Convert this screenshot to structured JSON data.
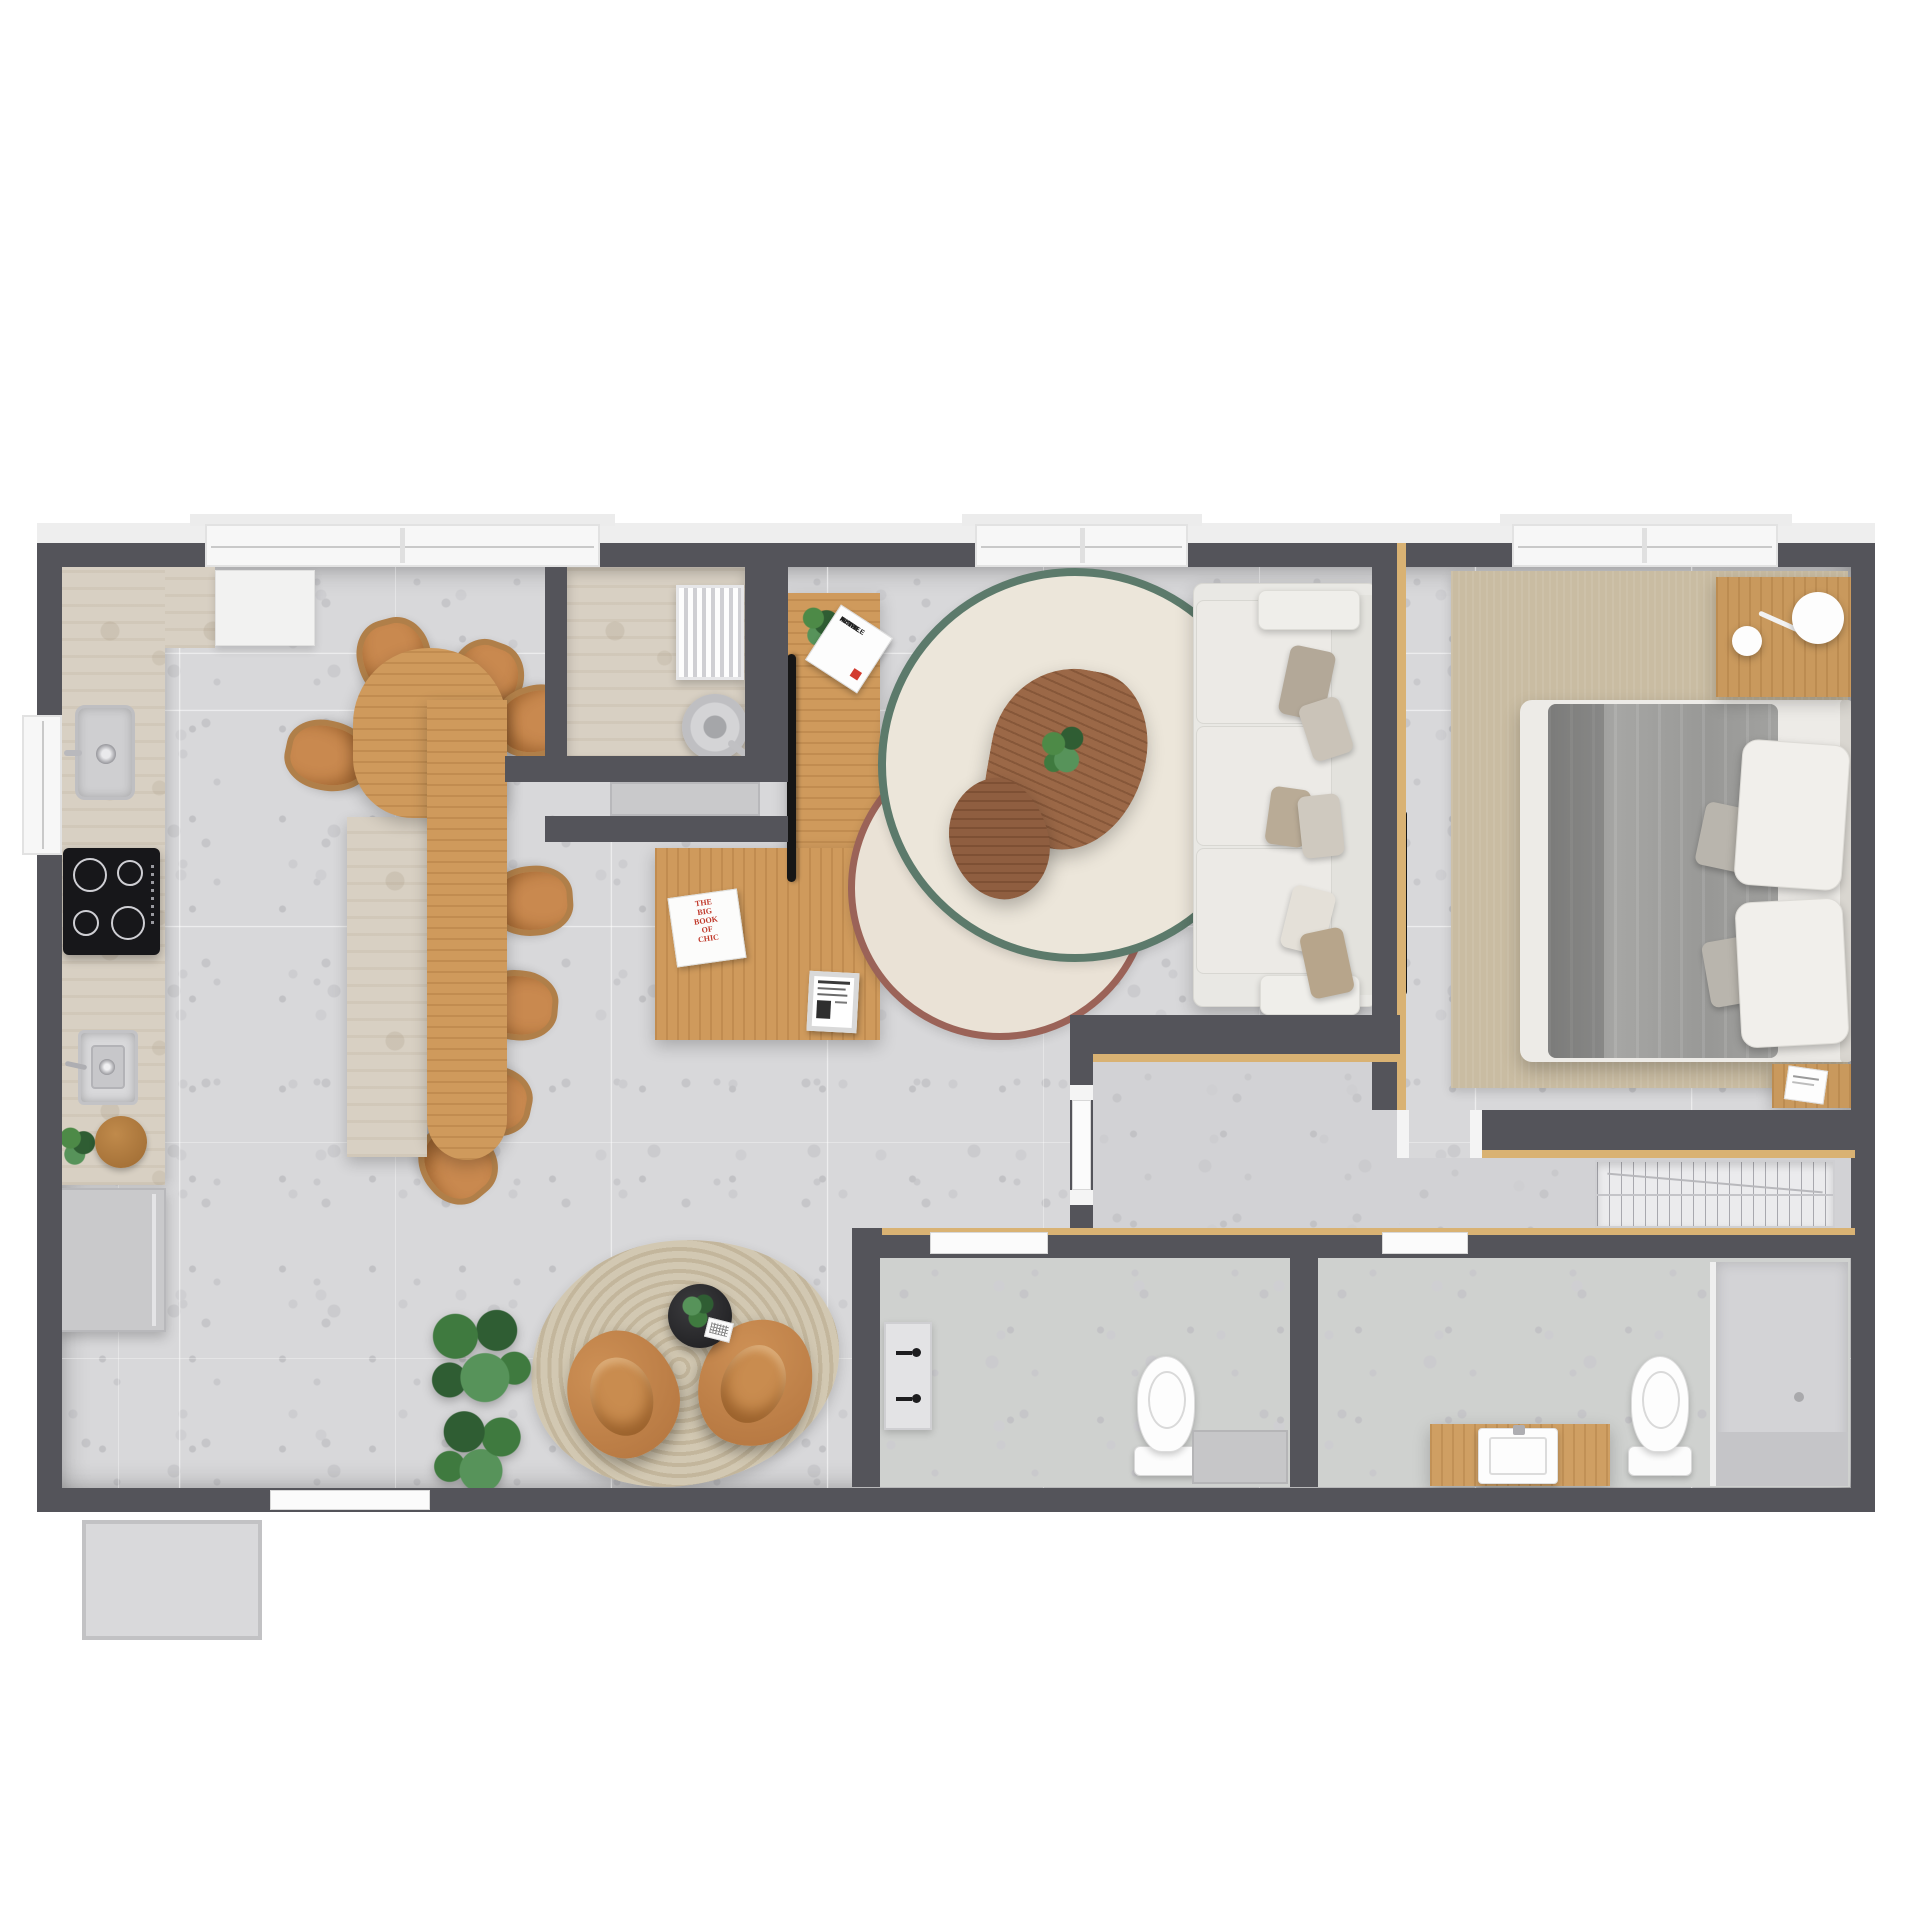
{
  "page": {
    "kind": "apartment floor plan render, top-down view",
    "background": "#ffffff"
  },
  "palette": {
    "wall": "#54545a",
    "floor_terrazzo": "#d8d8da",
    "floor_bathroom": "#cfd1cf",
    "counter_travertine": "#d8d0c3",
    "wood_oak": "#cf9a5c",
    "wood_walnut": "#9b6847",
    "trim_wood": "#d9b273",
    "rug_green_ring": "#5c7a6b",
    "rug_maroon_ring": "#9b6358",
    "rug_cream_fill": "#ece6da",
    "rug_bedroom": "#c9bca2",
    "rug_rope": "#cfc5ae",
    "leather_cognac": "#c9894f",
    "sofa_fabric": "#e9e8e4",
    "bed_blanket": "#9e9e9c",
    "tv_black": "#161616",
    "door_white": "#fbfbfb",
    "appliance_gray": "#c9c9cb"
  },
  "books": {
    "console_book": {
      "title_lines": [
        "A SMILE",
        "IN THE",
        "MIND"
      ],
      "accent": "#d23b2f"
    },
    "desk_book": {
      "title_lines": [
        "THE",
        "BIG",
        "BOOK",
        "OF",
        "CHIC"
      ],
      "color": "#c0392b"
    }
  },
  "rooms": [
    {
      "name": "kitchen-dining",
      "features": [
        "travertine counter",
        "induction cooktop",
        "square sink",
        "wall basin",
        "refrigerator",
        "long oak table",
        "stone bench",
        "8 cognac chairs"
      ]
    },
    {
      "name": "utility-niche",
      "features": [
        "radiator",
        "round pan",
        "gray cabinet front"
      ]
    },
    {
      "name": "living-room",
      "features": [
        "oak tv console",
        "tv",
        "oak desk",
        "green ring rug",
        "maroon ring rug",
        "2 walnut coffee tables",
        "plant",
        "white 3-seat sofa"
      ]
    },
    {
      "name": "lounge-nook",
      "features": [
        "rope rug",
        "2 cognac armchairs",
        "black side table",
        "monstera plants"
      ]
    },
    {
      "name": "bedroom",
      "features": [
        "beige rug",
        "double bed",
        "gray blanket",
        "2 white pillows",
        "nightstand",
        "disc lamp",
        "wall tv",
        "book shelf"
      ]
    },
    {
      "name": "corridor",
      "features": [
        "wood trim walls",
        "wardrobe hanger rack"
      ]
    },
    {
      "name": "bathroom-social",
      "features": [
        "toilet",
        "wall basin with black taps",
        "gray counter"
      ]
    },
    {
      "name": "bathroom-suite",
      "features": [
        "wood counter",
        "white square sink",
        "toilet",
        "shower area"
      ]
    }
  ],
  "windows": {
    "count": 4,
    "positions": [
      "kitchen top",
      "living top",
      "bedroom top",
      "kitchen left"
    ]
  }
}
